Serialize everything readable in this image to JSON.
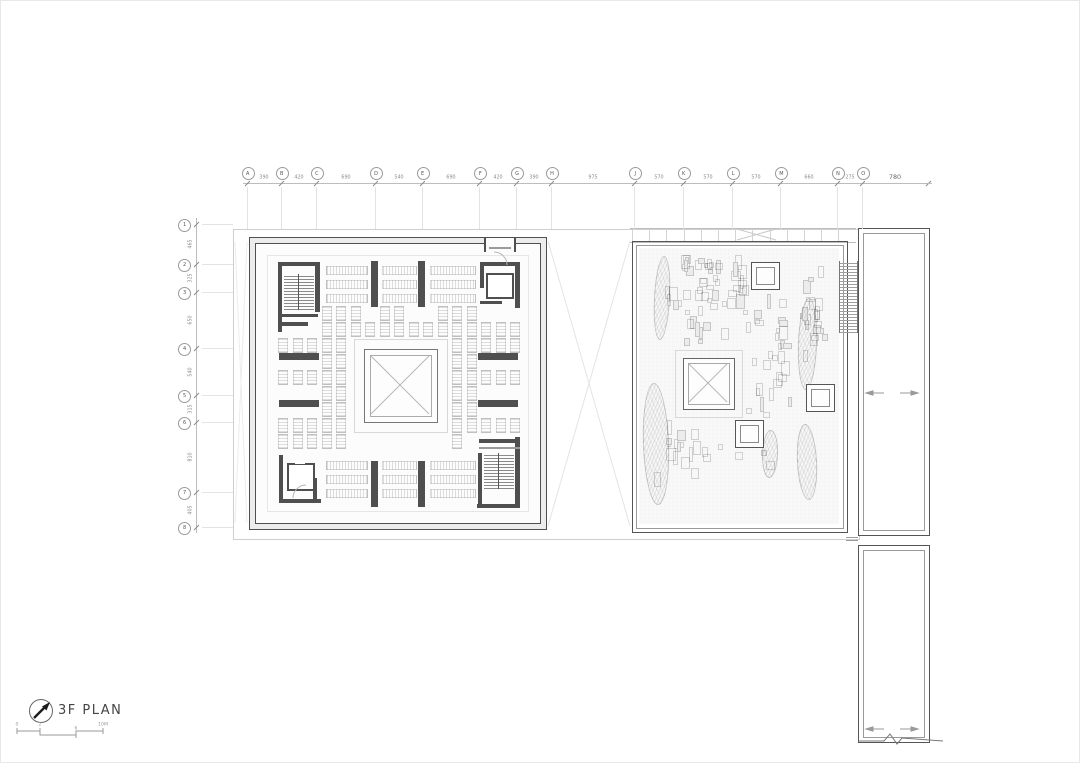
{
  "sheet": {
    "title": "3F PLAN",
    "drawing_type": "architectural floor plan",
    "colors": {
      "paper": "#ffffff",
      "wall_dark": "#4f4f4f",
      "line_mid": "#909090",
      "line_light": "#c4c4c4",
      "hatch": "rgba(0,0,0,0.12)"
    }
  },
  "legend": {
    "title": "3F PLAN",
    "north_icon": "north-arrow-icon",
    "scale_labels": [
      "0",
      "2",
      "6",
      "10M"
    ]
  },
  "grid_top": {
    "labels": [
      "A",
      "B",
      "C",
      "D",
      "E",
      "F",
      "G",
      "H",
      "J",
      "K",
      "L",
      "M",
      "N",
      "O"
    ],
    "dims": [
      "390",
      "420",
      "690",
      "540",
      "690",
      "420",
      "390",
      "975",
      "570",
      "570",
      "570",
      "660",
      "275"
    ],
    "end_dim": "780"
  },
  "grid_left": {
    "labels": [
      "1",
      "2",
      "3",
      "4",
      "5",
      "6",
      "7",
      "8"
    ],
    "dims": [
      "465",
      "325",
      "650",
      "540",
      "315",
      "810",
      "405"
    ]
  },
  "plan_features": {
    "left_block": "square hall with central skylight atrium, four corner stair/elevator cores, library stack shelving grid",
    "right_block": "roof garden with scattered planters, three small skylights, one large skylight, edge stair",
    "right_tower": "tall service bar with section break at base",
    "symbols": [
      "north-arrow-icon",
      "scale-bar",
      "section-break-zigzag",
      "paired-direction-arrows"
    ]
  }
}
